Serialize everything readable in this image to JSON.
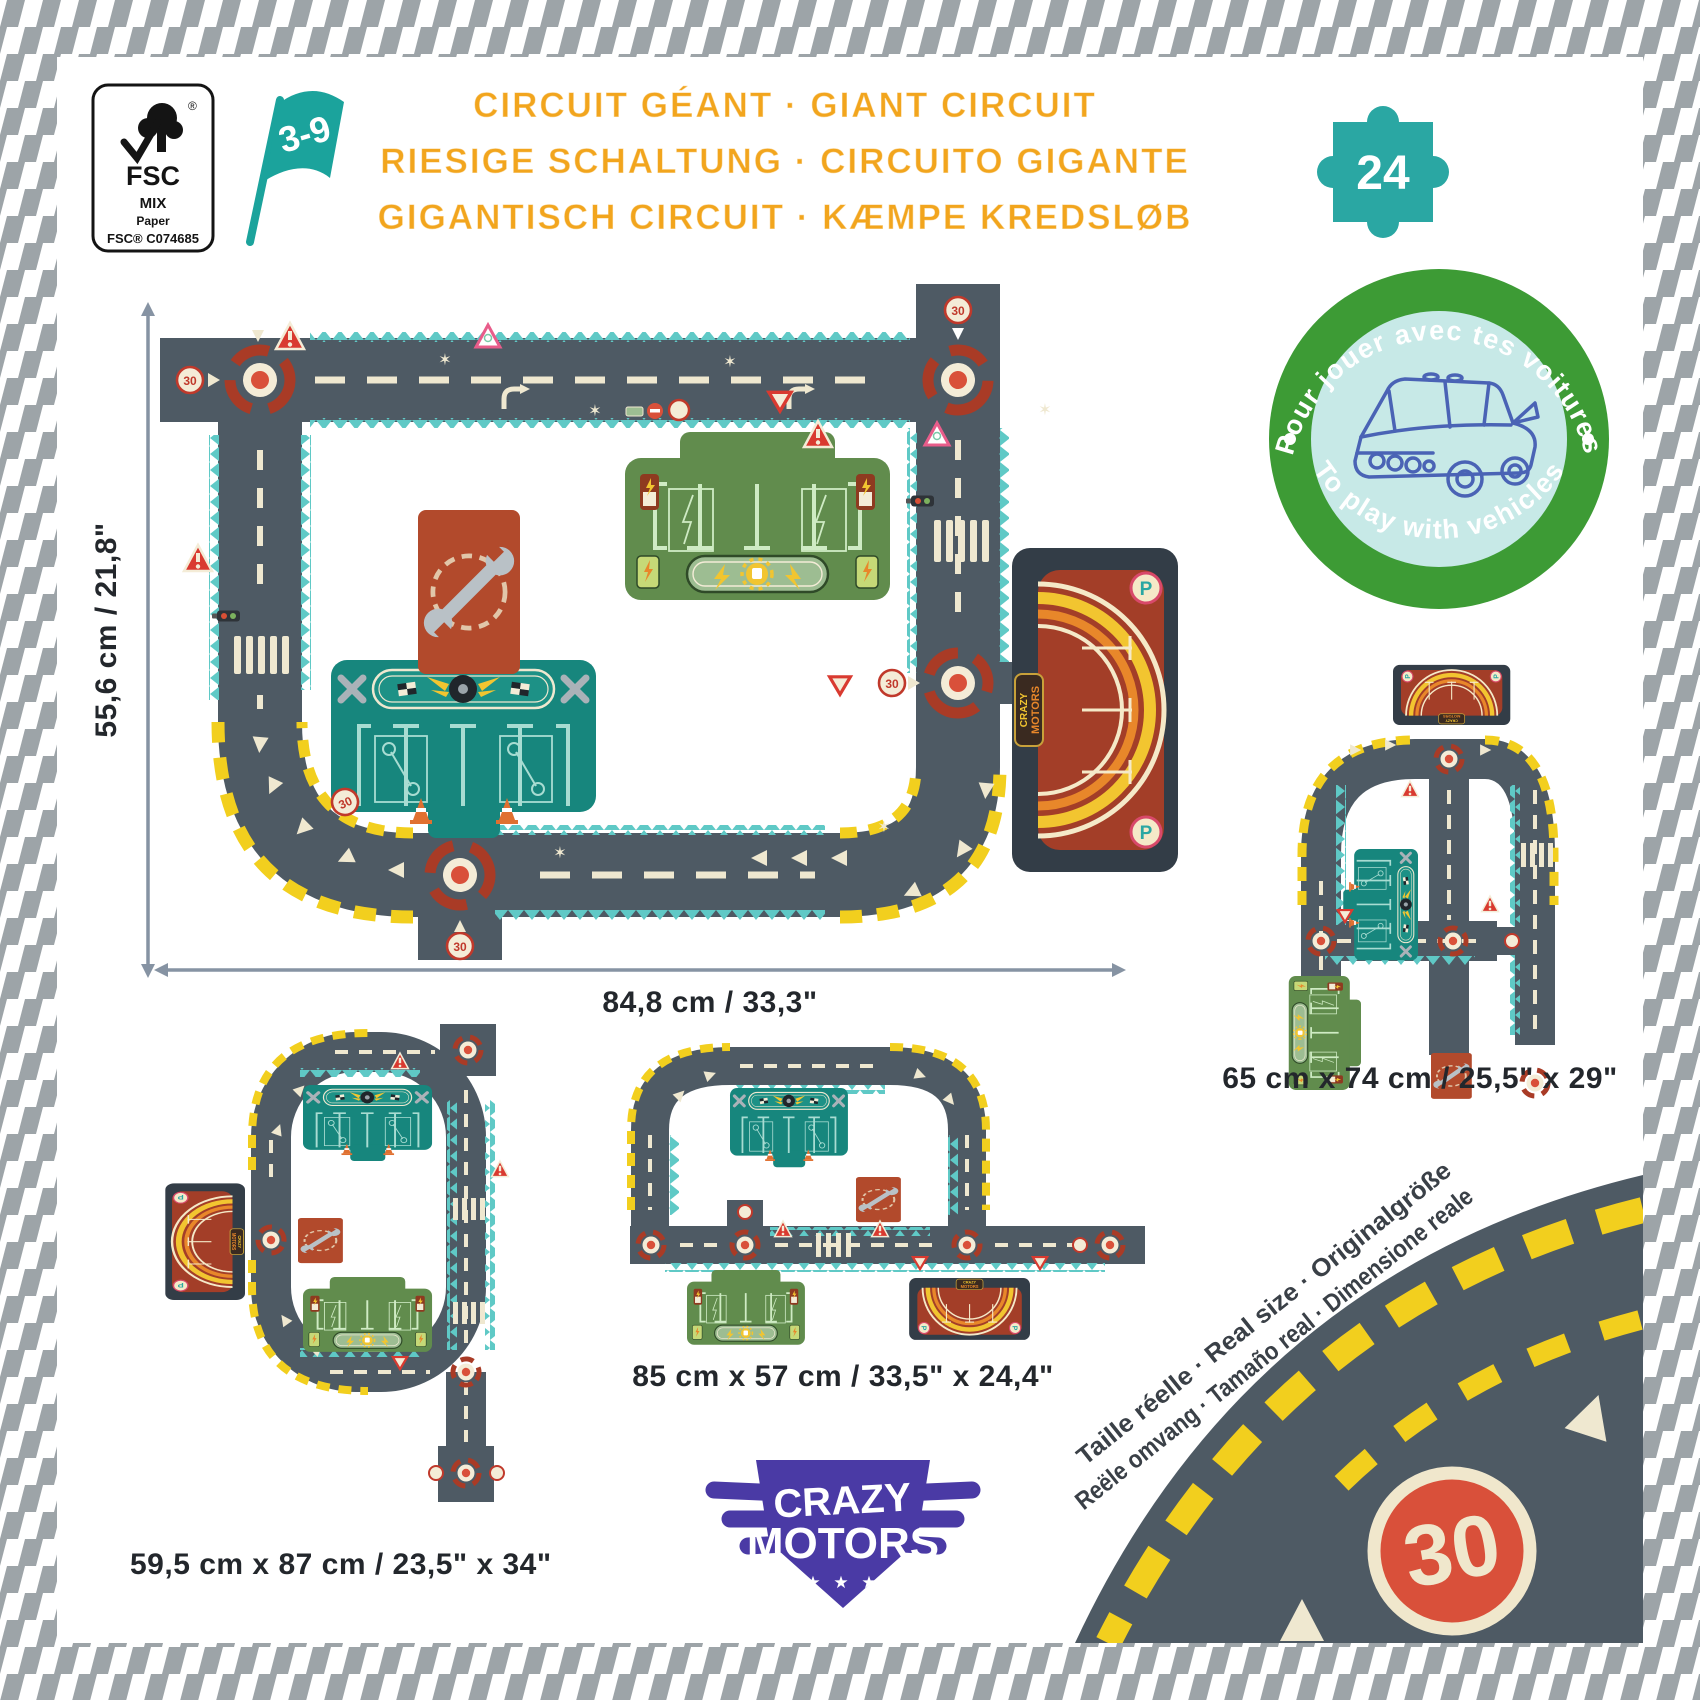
{
  "product": {
    "title_line1": "CIRCUIT GÉANT · GIANT CIRCUIT",
    "title_line2": "RIESIGE SCHALTUNG · CIRCUITO GIGANTE",
    "title_line3": "GIGANTISCH CIRCUIT · KÆMPE KREDSLØB",
    "age_range": "3-9",
    "piece_count": "24"
  },
  "fsc": {
    "brand": "FSC",
    "reg": "®",
    "mix": "MIX",
    "paper": "Paper",
    "code": "FSC® C074685"
  },
  "play_badge": {
    "arc_top": "Pour jouer avec tes voitures",
    "arc_bottom": "To play with vehicles"
  },
  "dimensions": {
    "main_height": "55,6 cm / 21,8\"",
    "main_width": "84,8 cm / 33,3\"",
    "variant_a": "65 cm x 74 cm / 25,5\" x 29\"",
    "variant_b": "59,5 cm x 87 cm / 23,5\" x 34\"",
    "variant_c": "85 cm x 57 cm / 33,5\" x 24,4\""
  },
  "logo": {
    "line1": "CRAZY",
    "line2": "MOTORS",
    "stars": "★ ★ ★"
  },
  "real_size": {
    "line1": "Taille réelle · Real size · Originalgröße",
    "line2": "Reële omvang · Tamaño real · Dimensione reale"
  },
  "road": {
    "speed": "30",
    "parking": "P"
  },
  "icons": {
    "sparkle": "✶"
  },
  "colors": {
    "title_orange": "#F2A51D",
    "teal": "#2AA7A3",
    "badge_green": "#3D9B35",
    "badge_inner": "#C7E9E7",
    "car_blue": "#4A63B5",
    "asphalt": "#4E5A64",
    "edge_teal": "#5FC9C6",
    "marking_cream": "#EFE8D0",
    "hazard_yellow": "#F2CF1E",
    "roundabout_red": "#A93B26",
    "dot_red": "#D9503A",
    "mat_green": "#618C4D",
    "mat_teal": "#17867D",
    "parking_dark": "#333D47",
    "parking_red": "#A33E28",
    "wrench_square": "#B24A2C",
    "logo_purple": "#4A3AA5",
    "border_gray": "#9DA4A8"
  }
}
